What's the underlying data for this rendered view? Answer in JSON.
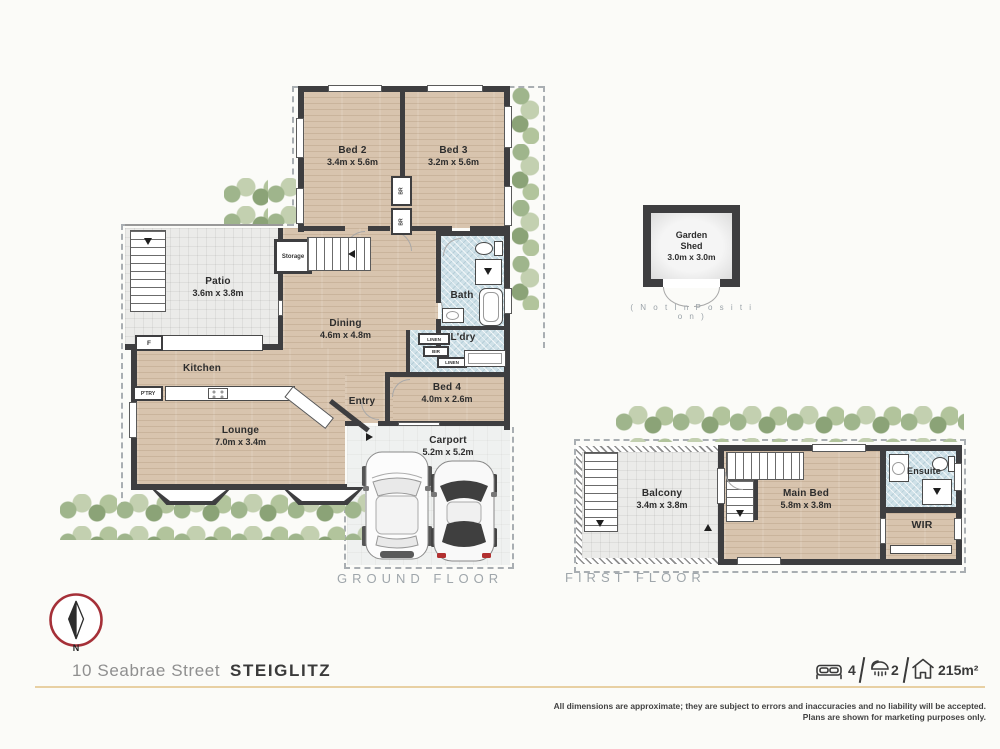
{
  "ground": {
    "label": "GROUND FLOOR",
    "bed2": {
      "name": "Bed 2",
      "dims": "3.4m x 5.6m"
    },
    "bed3": {
      "name": "Bed 3",
      "dims": "3.2m x 5.6m"
    },
    "patio": {
      "name": "Patio",
      "dims": "3.6m x 3.8m"
    },
    "storage": {
      "name": "Storage"
    },
    "dining": {
      "name": "Dining",
      "dims": "4.6m x 4.8m"
    },
    "bath": {
      "name": "Bath"
    },
    "laundry": {
      "name": "L'dry"
    },
    "linen": {
      "name": "LINEN"
    },
    "bir": {
      "name": "BIR"
    },
    "br": {
      "name": "BR"
    },
    "kitchen": {
      "name": "Kitchen"
    },
    "pantry": {
      "name": "P'TRY"
    },
    "fridge": {
      "name": "F"
    },
    "entry": {
      "name": "Entry"
    },
    "bed4": {
      "name": "Bed 4",
      "dims": "4.0m x 2.6m"
    },
    "lounge": {
      "name": "Lounge",
      "dims": "7.0m x 3.4m"
    },
    "carport": {
      "name": "Carport",
      "dims": "5.2m x 5.2m"
    }
  },
  "shed": {
    "name": "Garden Shed",
    "dims": "3.0m x 3.0m",
    "note": "( N o t   I n   P o s i t i o n )"
  },
  "first": {
    "label": "FIRST FLOOR",
    "balcony": {
      "name": "Balcony",
      "dims": "3.4m x 3.8m"
    },
    "main_bed": {
      "name": "Main Bed",
      "dims": "5.8m x 3.8m"
    },
    "ensuite": {
      "name": "Ensuite"
    },
    "wir": {
      "name": "WIR"
    }
  },
  "footer": {
    "compass_n": "N",
    "street": "10 Seabrae Street",
    "suburb": "STEIGLITZ",
    "beds": "4",
    "baths": "2",
    "area": "215m²",
    "disclaimer1": "All dimensions are approximate; they are subject to errors and inaccuracies and no liability will be accepted.",
    "disclaimer2": "Plans are shown for marketing purposes only."
  },
  "colors": {
    "wall": "#3e3e40",
    "wood_floor": "#d8c4ae",
    "wet_area_tile": "#cfe1e8",
    "accent_rule": "#e8d0a3",
    "compass_ring": "#a53038",
    "foliage": "#9fb58c",
    "boundary_dash": "#a9aeb2"
  }
}
